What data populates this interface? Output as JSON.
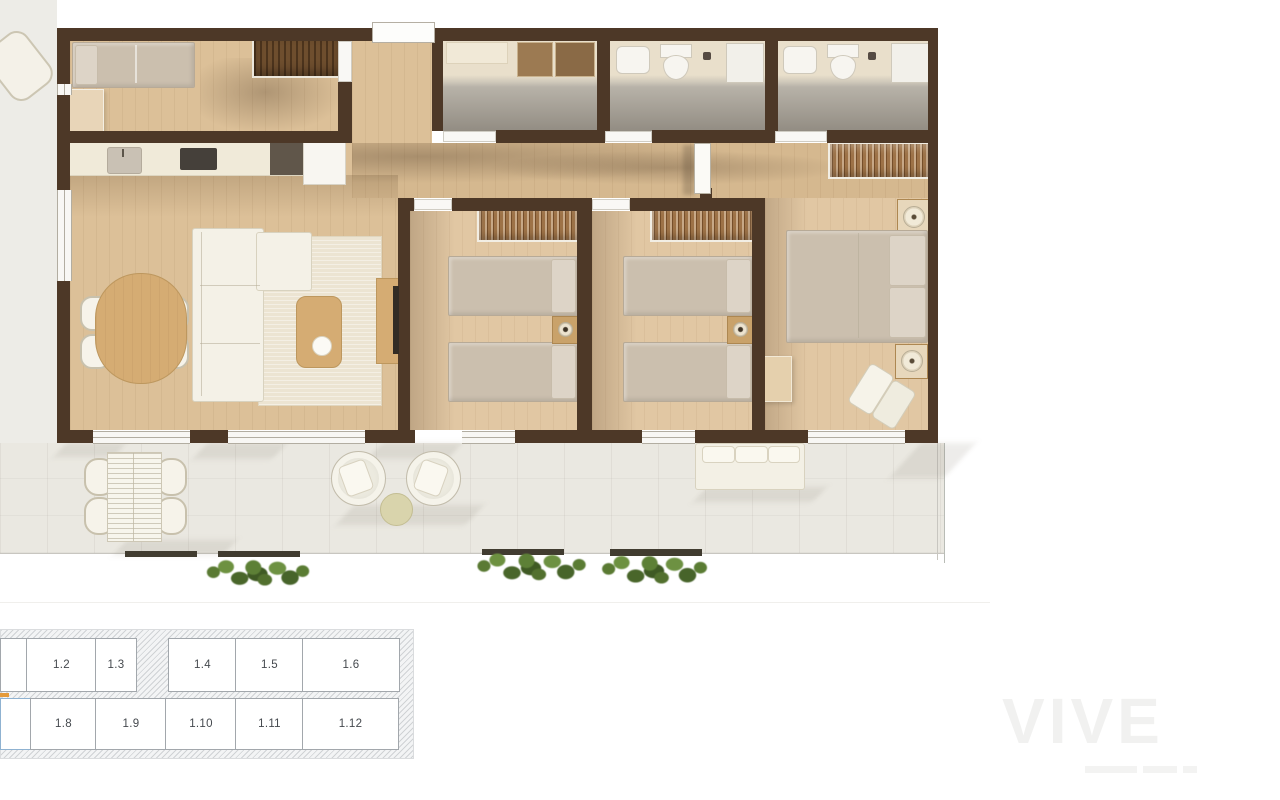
{
  "key_plan": {
    "row1": [
      {
        "label": ""
      },
      {
        "label": "1.2"
      },
      {
        "label": "1.3"
      },
      {
        "label": "1.4"
      },
      {
        "label": "1.5"
      },
      {
        "label": "1.6"
      }
    ],
    "row2": [
      {
        "label": ""
      },
      {
        "label": "1.8"
      },
      {
        "label": "1.9"
      },
      {
        "label": "1.10"
      },
      {
        "label": "1.11"
      },
      {
        "label": "1.12"
      }
    ],
    "highlight_color": "#cfe3f2"
  },
  "watermark": {
    "text": "VIVE"
  },
  "colors": {
    "wall": "#4d3827",
    "wood_floor": "#dfc49f",
    "bathroom_floor": "#bdb8ae",
    "terrace_floor": "#eae8e1",
    "keyplan_highlight": "#cfe3f2"
  }
}
